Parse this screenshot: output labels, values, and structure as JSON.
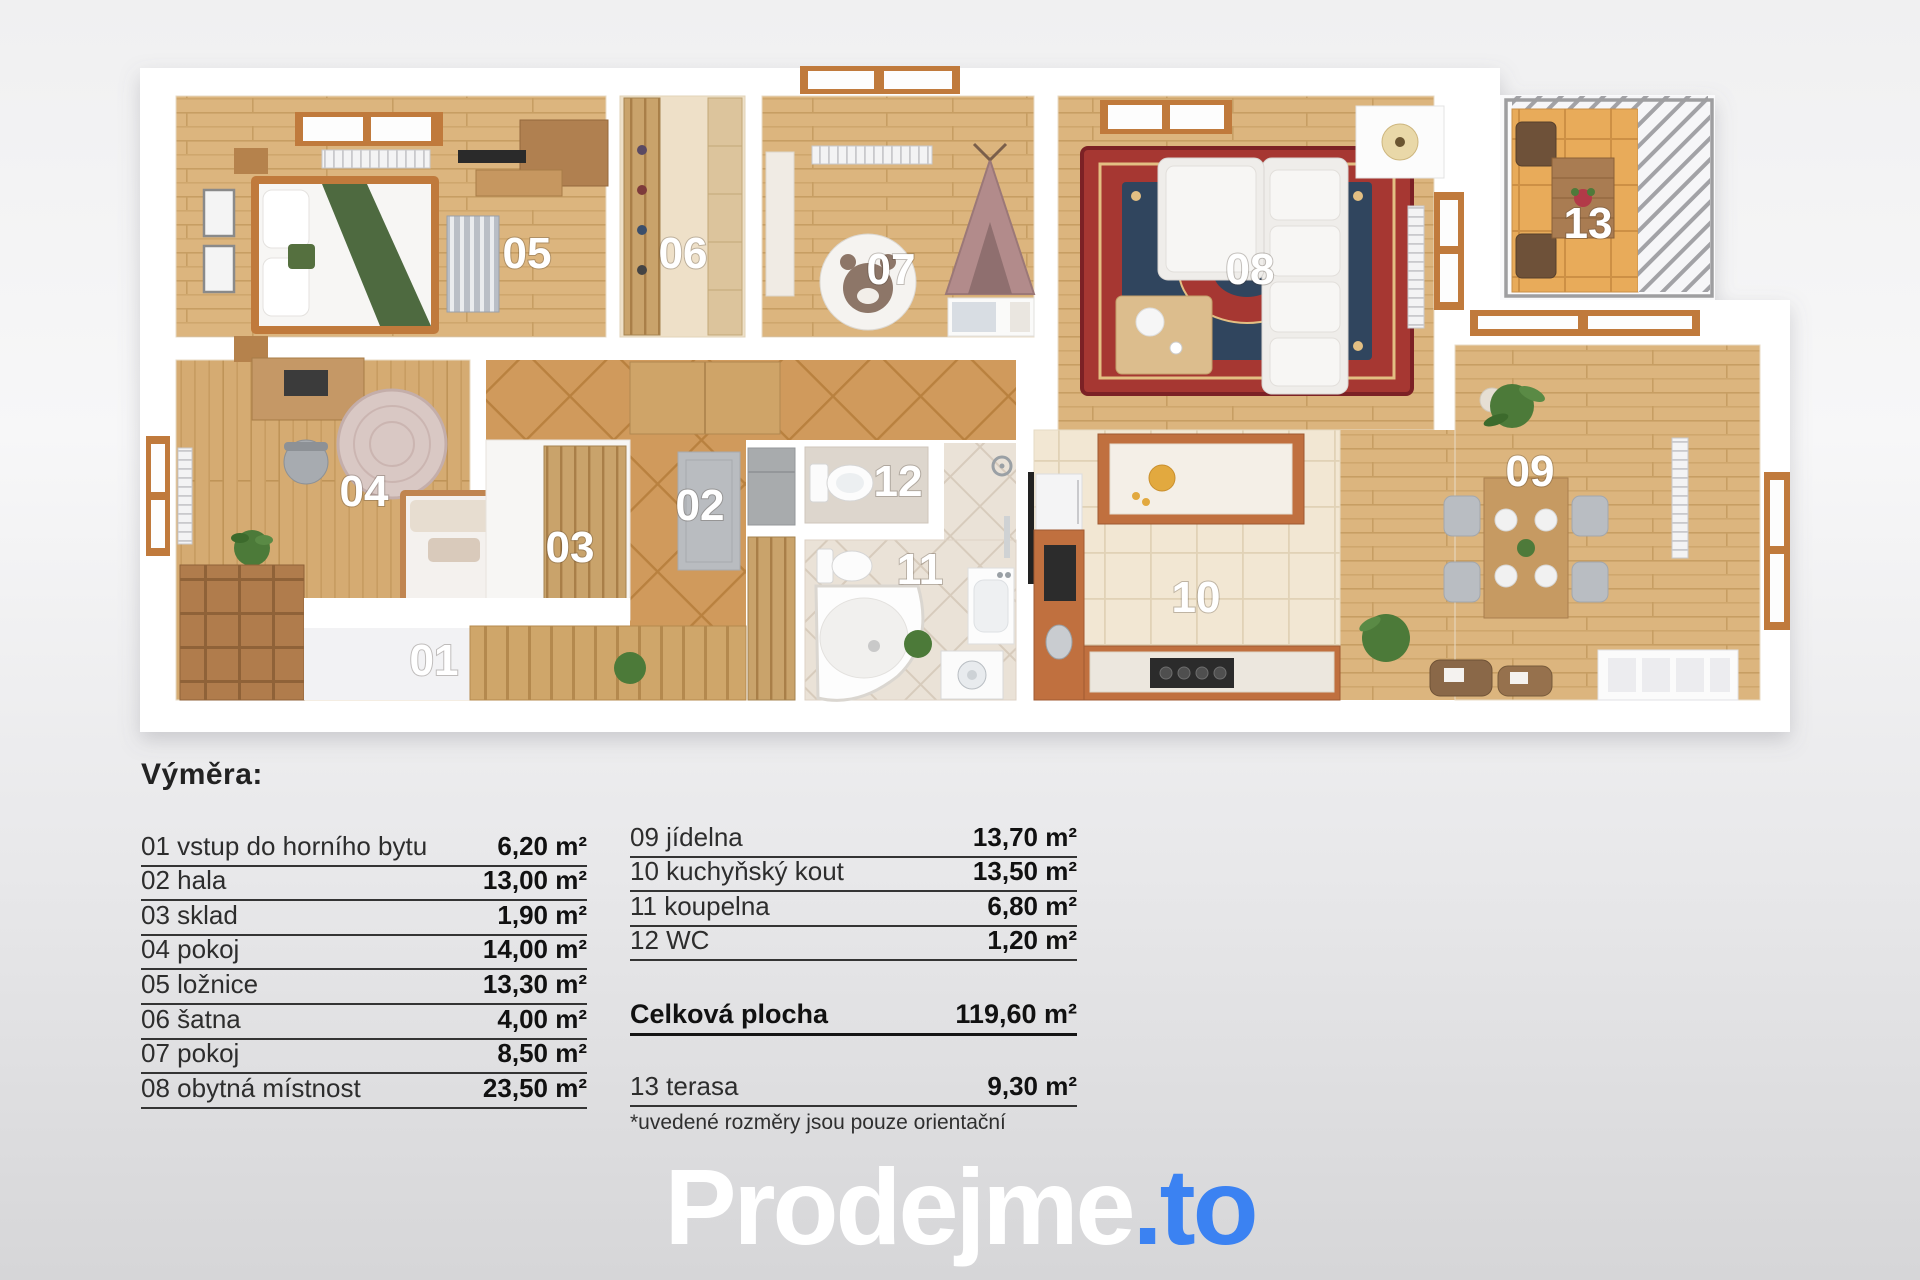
{
  "plan": {
    "rooms": [
      {
        "number": "01",
        "name": "vstup do horního bytu",
        "area": "6,20 m²"
      },
      {
        "number": "02",
        "name": "hala",
        "area": "13,00 m²"
      },
      {
        "number": "03",
        "name": "sklad",
        "area": "1,90 m²"
      },
      {
        "number": "04",
        "name": "pokoj",
        "area": "14,00 m²"
      },
      {
        "number": "05",
        "name": "ložnice",
        "area": "13,30 m²"
      },
      {
        "number": "06",
        "name": "šatna",
        "area": "4,00 m²"
      },
      {
        "number": "07",
        "name": "pokoj",
        "area": "8,50 m²"
      },
      {
        "number": "08",
        "name": "obytná místnost",
        "area": "23,50 m²"
      },
      {
        "number": "09",
        "name": "jídelna",
        "area": "13,70 m²"
      },
      {
        "number": "10",
        "name": "kuchyňský kout",
        "area": "13,50 m²"
      },
      {
        "number": "11",
        "name": "koupelna",
        "area": "6,80 m²"
      },
      {
        "number": "12",
        "name": "WC",
        "area": "1,20 m²"
      },
      {
        "number": "13",
        "name": "terasa",
        "area": "9,30 m²"
      }
    ],
    "colors": {
      "wood": "#dcb57e",
      "hall_tile": "#d09a5c",
      "kitchen_tile": "#f2e7d3",
      "bath_tile": "#eae2d7",
      "terrace_tile": "#e8ab5a",
      "wall": "#ffffff",
      "accent_wood": "#c0703f",
      "rug_red": "#a63732",
      "rug_navy": "#30455e"
    }
  },
  "legend": {
    "title": "Výměra:",
    "left_rows": [
      {
        "name": "01 vstup do horního bytu",
        "value": "6,20 m²"
      },
      {
        "name": "02 hala",
        "value": "13,00 m²"
      },
      {
        "name": "03 sklad",
        "value": "1,90 m²"
      },
      {
        "name": "04 pokoj",
        "value": "14,00 m²"
      },
      {
        "name": "05 ložnice",
        "value": "13,30 m²"
      },
      {
        "name": "06 šatna",
        "value": "4,00 m²"
      },
      {
        "name": "07 pokoj",
        "value": "8,50 m²"
      },
      {
        "name": "08 obytná místnost",
        "value": "23,50 m²"
      }
    ],
    "right_rows": [
      {
        "name": "09 jídelna",
        "value": "13,70 m²"
      },
      {
        "name": "10 kuchyňský kout",
        "value": "13,50 m²"
      },
      {
        "name": "11 koupelna",
        "value": "6,80 m²"
      },
      {
        "name": "12 WC",
        "value": "1,20 m²"
      }
    ],
    "total": {
      "name": "Celková plocha",
      "value": "119,60 m²"
    },
    "terrace_row": {
      "name": "13 terasa",
      "value": "9,30 m²"
    },
    "footnote": "*uvedené rozměry jsou pouze orientační"
  },
  "logo": {
    "text_primary": "Prodejme",
    "text_accent": ".to",
    "accent_color": "#3b82f2",
    "primary_color": "#ffffff"
  }
}
